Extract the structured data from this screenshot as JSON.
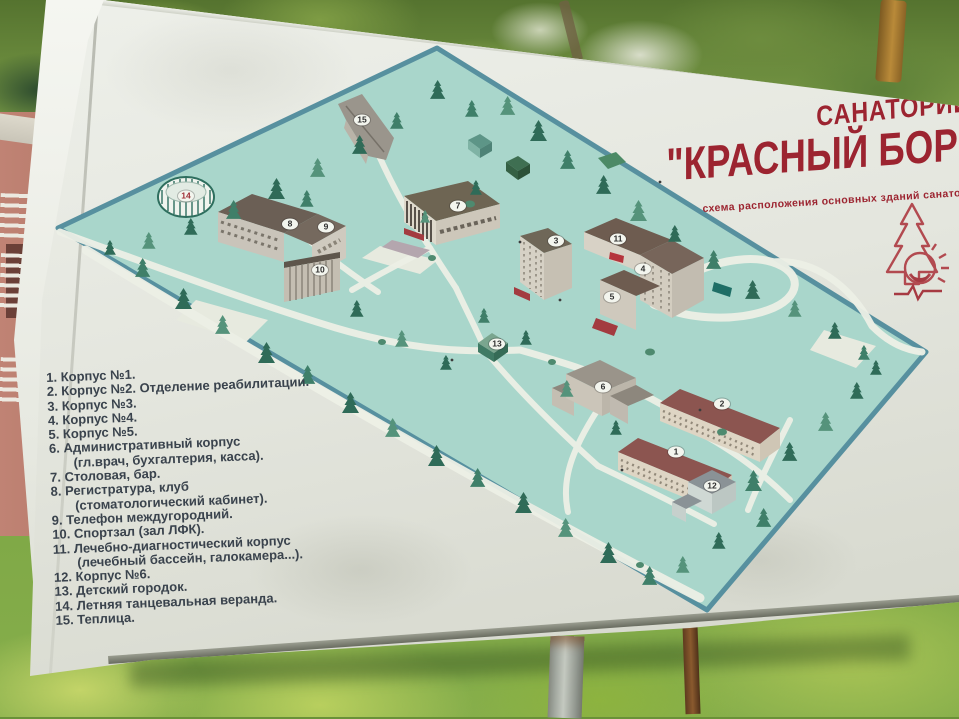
{
  "sign": {
    "title_top": "САНАТОРИЙ",
    "title_main": "\"КРАСНЫЙ БОР\"",
    "subtitle": "схема расположения основных зданий санатория"
  },
  "legend": {
    "lines": [
      "1. Корпус №1.",
      "2. Корпус №2. Отделение реабилитации.",
      "3. Корпус №3.",
      "4. Корпус №4.",
      "5. Корпус №5.",
      "6. Административный корпус",
      "(гл.врач, бухгалтерия, касса).",
      "7. Столовая, бар.",
      "8. Регистратура, клуб",
      "(стоматологический кабинет).",
      "9. Телефон междугородний.",
      "10. Спортзал (зал ЛФК).",
      "11. Лечебно-диагностический корпус",
      "(лечебный бассейн, галокамера...).",
      "12. Корпус №6.",
      "13. Детский городок.",
      "14. Летняя танцевальная веранда.",
      "15. Теплица."
    ]
  },
  "map": {
    "labels": [
      "1",
      "2",
      "3",
      "4",
      "5",
      "6",
      "7",
      "8",
      "9",
      "10",
      "11",
      "12",
      "13",
      "14",
      "15"
    ]
  },
  "colors": {
    "title_red": "#9c2430",
    "legend_text": "#3a434d",
    "map_fill": "#a9d6cb",
    "map_border": "#57909f",
    "roof_red": "#8c5550",
    "sign_face": "#e4e6de"
  }
}
